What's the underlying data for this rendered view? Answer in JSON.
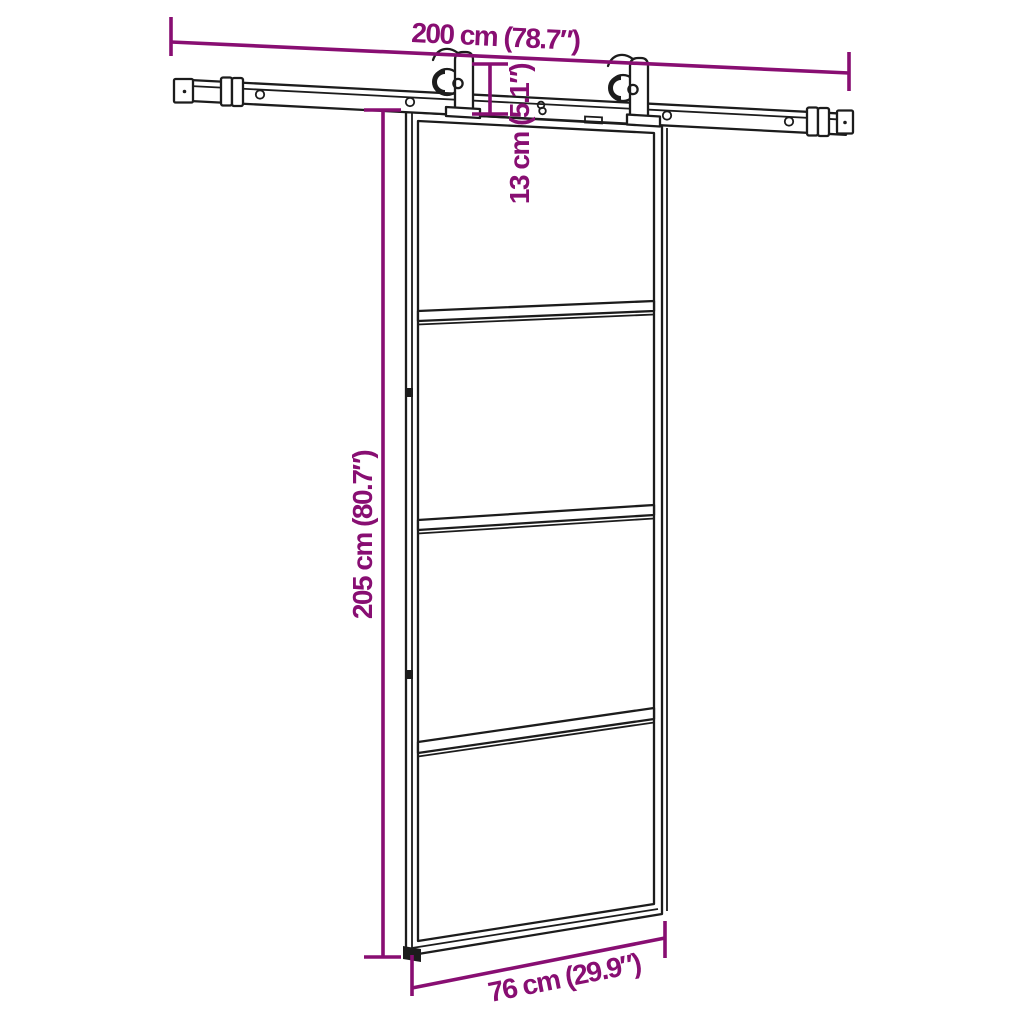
{
  "diagram": {
    "type": "product-dimension-diagram",
    "subject": "sliding barn door with overhead roller track",
    "accent_color": "#880E72",
    "line_color": "#1c1c1c",
    "background_color": "#ffffff",
    "glass_panel_count": 4,
    "roller_count": 2,
    "dimensions": {
      "track_width": {
        "label": "200 cm (78.7″)"
      },
      "drop_height": {
        "label": "13 cm (5.1″)"
      },
      "door_height": {
        "label": "205 cm (80.7″)"
      },
      "door_width": {
        "label": "76 cm (29.9″)"
      }
    }
  }
}
